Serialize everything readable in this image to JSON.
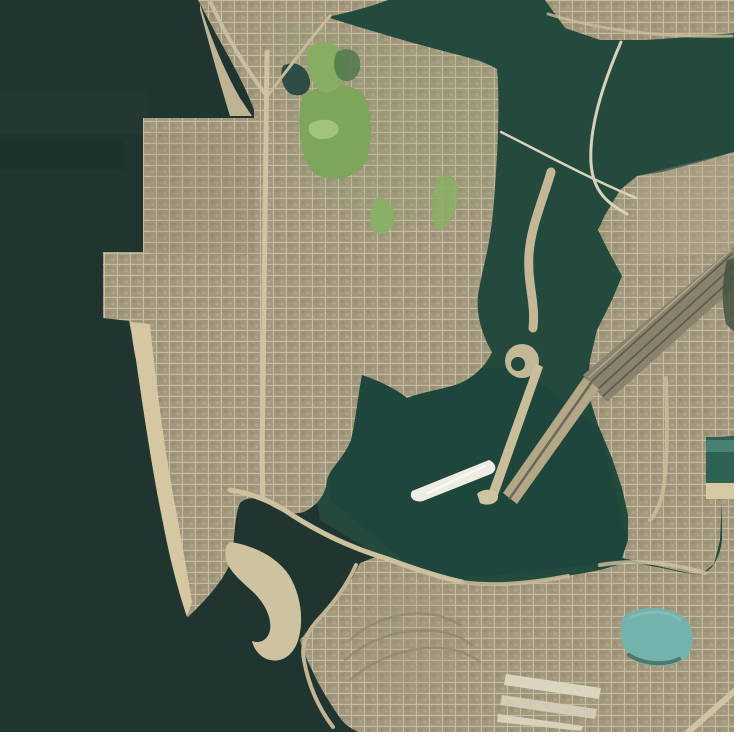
{
  "meta": {
    "kind": "satellite-aerial-photograph",
    "description": "Overhead satellite view of a coastal harbor city: dark sea on the west, a large bay in the northeast, a gridded urban landmass in the center, a green park at top, bridges and causeways over channels, a boat wake in the central basin, a sandy hook spit, a light-teal pond and rail corridor at the lower right. White margins on right and bottom edges.",
    "width": 740,
    "height": 738
  },
  "palette": {
    "ocean": "#213530",
    "bay": "#244a3e",
    "basin": "#1e463c",
    "urban_base": "#a79d84",
    "urban_block": "#a1977d",
    "street": "#c6bb9f",
    "sand": "#d4c7a2",
    "park_green": "#7da55c",
    "pond_teal": "#74b2ac",
    "bridge": "#d9d1b9",
    "wake_white": "#eceee4",
    "rail_dark": "#8a826d",
    "margin_white": "#ffffff"
  },
  "features": [
    "open-sea-west",
    "north-bay",
    "central-basin-with-boat-wake",
    "street-grid-city",
    "hilltop-park",
    "two-bay-bridges",
    "winding-channel-causeway",
    "twin-jetty-causeways",
    "rail-corridor",
    "beach-strip-peninsula",
    "hook-sand-spit",
    "teal-pond",
    "dock-basin-right-edge",
    "industrial-warehouses"
  ],
  "map": {
    "viewbox": "0 0 740 738",
    "layers": [
      {
        "name": "sea-base",
        "shape": "rect",
        "x": 0,
        "y": 0,
        "w": 740,
        "h": 738,
        "fill": "#213530"
      },
      {
        "name": "sea-current-band-1",
        "shape": "rect",
        "x": 0,
        "y": 92,
        "w": 150,
        "h": 42,
        "fill": "#27403a",
        "opacity": 0.35
      },
      {
        "name": "sea-current-band-2",
        "shape": "rect",
        "x": 0,
        "y": 140,
        "w": 125,
        "h": 30,
        "fill": "#1b2d28",
        "opacity": 0.35
      },
      {
        "name": "bay-water",
        "shape": "path",
        "d": "M280,0 L740,0 L740,612 L470,612 L320,520 L280,300 Z",
        "fill": "#244a3e"
      },
      {
        "name": "basin-water",
        "shape": "path",
        "d": "M330,368 L520,368 L600,428 L632,560 L430,582 L330,500 Z",
        "fill": "#1e463c",
        "opacity": 0.9
      },
      {
        "name": "central-landmass",
        "shape": "path",
        "d": "M198,0 L388,0 C370,7 346,13 327,17 C355,26 395,38 432,48 C458,55 482,60 497,69 C500,100 498,150 494,200 C491,245 483,265 478,295 C476,315 482,335 492,352 C486,366 473,378 458,384 C440,390 422,392 407,398 C398,390 380,381 362,375 C358,395 356,418 351,440 C344,458 330,468 327,480 C326,492 320,504 304,512 C292,515 282,513 270,505 C258,497 247,496 240,503 C235,515 234,535 233,556 C226,578 208,598 188,617 C177,575 163,510 152,445 C143,395 135,350 129,321 L103,318 L103,252 L143,252 L143,118 L254,118 L254,110 C247,90 232,62 216,34 Z",
        "fill": "url(#urban)"
      },
      {
        "name": "north-shore-strip",
        "shape": "path",
        "d": "M545,0 L734,0 L734,33 L690,37 L645,40 L600,40 L565,28 Z",
        "fill": "url(#urban)"
      },
      {
        "name": "east-landmass",
        "shape": "path",
        "d": "M734,152 L700,162 L662,172 L637,176 L620,190 L605,215 L598,230 L609,252 L622,276 L612,300 L597,330 L590,360 L587,390 L598,425 L612,458 L622,488 L628,515 L628,540 L622,558 L645,563 L675,570 L700,575 L714,564 L720,540 L722,502 L712,496 L706,484 L706,438 L734,436 Z",
        "fill": "url(#urban)"
      },
      {
        "name": "south-landmass",
        "shape": "path",
        "d": "M300,640 L318,618 L338,598 L352,578 L360,563 L378,556 C390,558 400,562 410,567 C428,574 448,581 468,584 C490,586 515,585 540,580 C560,577 580,574 600,570 L628,562 C645,565 660,567 680,572 L700,575 C707,572 712,568 714,564 C719,556 721,548 722,540 L722,502 L712,496 L706,484 L734,484 L734,732 L358,732 C350,728 344,724 340,718 C330,703 320,688 312,670 C306,658 302,648 300,640 Z",
        "fill": "url(#urban)"
      },
      {
        "name": "park-slope-cast",
        "shape": "path",
        "d": "M280,20 L480,60 L497,69 L494,200 L380,232 L300,180 Z",
        "fill": "#9aa37c",
        "opacity": 0.22
      },
      {
        "name": "downtown-shade",
        "shape": "rect",
        "x": 150,
        "y": 130,
        "w": 105,
        "h": 125,
        "fill": "#8f8267",
        "opacity": 0.18
      },
      {
        "name": "east-city-light",
        "shape": "path",
        "d": "M637,176 L734,152 L734,250 L640,262 Z",
        "fill": "#b6ab8e",
        "opacity": 0.3
      },
      {
        "name": "estate-rings-light",
        "shape": "circle",
        "cx": 408,
        "cy": 640,
        "r": 56,
        "fill": "#a1977c",
        "opacity": 0.25
      },
      {
        "name": "north-sand-strip",
        "shape": "path",
        "d": "M200,4 C210,36 224,70 240,98 L252,116 L230,116 C219,80 208,40 200,10 Z",
        "fill": "#cfc19d",
        "opacity": 0.9
      },
      {
        "name": "west-beach",
        "shape": "path",
        "d": "M131,322 L150,324 C156,384 165,455 177,515 C182,545 188,575 192,602 L187,617 C178,590 170,560 163,523 C152,470 143,408 136,360 C133,345 131,332 131,322 Z",
        "fill": "#d4c7a2"
      },
      {
        "name": "hook-sand-spit",
        "shape": "path",
        "d": "M230,542 C252,545 276,556 289,575 C300,593 304,617 299,637 C295,654 283,663 270,660 C261,658 254,650 252,641 C260,644 268,640 270,630 C272,617 264,602 252,591 C241,581 230,572 226,560 C224,551 226,545 230,542 Z",
        "fill": "#cfc2a0"
      },
      {
        "name": "park-main",
        "shape": "path",
        "d": "M302,98 C315,85 342,80 362,92 C372,105 374,140 366,162 C355,180 328,184 313,172 C300,158 296,120 302,98 Z",
        "fill": "#7da55c"
      },
      {
        "name": "park-upper",
        "shape": "path",
        "d": "M308,48 C322,38 340,42 346,58 C349,74 342,90 327,93 C313,92 303,66 308,48 Z",
        "fill": "#86ad62"
      },
      {
        "name": "park-meadow",
        "shape": "path",
        "d": "M310,124 C318,118 334,118 338,126 C341,134 332,140 320,139 C311,138 306,130 310,124 Z",
        "fill": "#a5c77f",
        "opacity": 0.9
      },
      {
        "name": "green-patch-south",
        "shape": "path",
        "d": "M377,198 C388,196 396,205 394,220 C392,232 382,238 374,232 C368,222 370,205 377,198 Z",
        "fill": "#8ab068"
      },
      {
        "name": "green-patch-east",
        "shape": "path",
        "d": "M440,175 C452,172 460,180 458,196 C456,215 448,232 438,230 C430,226 430,188 440,175 Z",
        "fill": "#8aaf66",
        "opacity": 0.85
      },
      {
        "name": "park-woods",
        "shape": "path",
        "d": "M337,52 C350,45 362,52 360,68 C358,81 345,85 338,77 C333,70 333,60 337,52 Z",
        "fill": "#567a50",
        "opacity": 0.9
      },
      {
        "name": "park-pond",
        "shape": "path",
        "d": "M283,66 C295,59 308,67 310,81 C311,93 301,98 291,94 C282,89 279,74 283,66 Z",
        "fill": "#2e4d44"
      },
      {
        "name": "road-top-west",
        "shape": "path",
        "d": "M211,3 C226,36 247,70 266,95",
        "stroke": "#cbbe9c",
        "width": 4
      },
      {
        "name": "road-top-east",
        "shape": "path",
        "d": "M268,95 C295,60 315,33 330,16",
        "stroke": "#c7ba96",
        "width": 3
      },
      {
        "name": "road-main-vertical",
        "shape": "path",
        "d": "M267,52 C266,150 264,280 263,400 C262,440 262,470 263,495",
        "stroke": "#d0c3a1",
        "width": 5
      },
      {
        "name": "road-shore",
        "shape": "path",
        "d": "M230,490 C255,494 275,503 292,515 C320,533 352,548 385,558 C412,568 438,577 462,582",
        "stroke": "#cdc19f",
        "width": 5
      },
      {
        "name": "road-shore-east",
        "shape": "path",
        "d": "M462,582 C495,587 532,583 568,576",
        "stroke": "#c6ba98",
        "width": 4,
        "opacity": 0.9
      },
      {
        "name": "road-inlet",
        "shape": "path",
        "d": "M356,565 C346,588 330,607 316,622 C306,634 301,647 304,660 C309,688 320,710 333,727",
        "stroke": "#c2b593",
        "width": 4
      },
      {
        "name": "road-east-vertical",
        "shape": "path",
        "d": "M666,378 C667,420 668,450 664,485 C662,500 657,512 650,520",
        "stroke": "#c8bb99",
        "width": 4,
        "opacity": 0.9
      },
      {
        "name": "road-north-shore",
        "shape": "path",
        "d": "M548,14 C600,30 660,38 732,36",
        "stroke": "#c9bd9b",
        "width": 3,
        "opacity": 0.8
      },
      {
        "name": "rail-corridor",
        "shape": "path",
        "d": "M734,246 L734,288 L607,402 L583,375 Z",
        "fill": "#8a826d"
      },
      {
        "name": "rail-tracks",
        "shape": "path",
        "d": "M732,254 L592,381 M733,266 L598,389 M733,278 L603,396",
        "stroke": "#605d4d",
        "width": 1.8
      },
      {
        "name": "rail-highlight",
        "shape": "path",
        "d": "M731,250 L589,377",
        "stroke": "#b0a88c",
        "width": 1.5
      },
      {
        "name": "channel-causeway",
        "shape": "path",
        "d": "M551,172 C543,200 531,226 529,254 C527,284 536,303 533,328",
        "stroke": "#c3b795",
        "width": 9
      },
      {
        "name": "causeway-bulb",
        "shape": "circle",
        "cx": 522,
        "cy": 361,
        "r": 17,
        "fill": "#c3b795"
      },
      {
        "name": "causeway-bulb-lagoon",
        "shape": "circle",
        "cx": 518,
        "cy": 364,
        "r": 7,
        "fill": "#234a3e"
      },
      {
        "name": "jetty-thin",
        "shape": "path",
        "d": "M535,363 L543,367 L497,498 L488,494 Z",
        "fill": "#cabd99"
      },
      {
        "name": "jetty-wide",
        "shape": "path",
        "d": "M584,377 L599,389 L517,504 L503,493 Z",
        "fill": "#b3a786"
      },
      {
        "name": "jetty-wide-streak",
        "shape": "path",
        "d": "M591,383 L510,498",
        "stroke": "#6d685a",
        "width": 2.5
      },
      {
        "name": "jetty-tip-sand",
        "shape": "path",
        "d": "M477,494 C482,488 496,488 498,496 C499,503 488,507 480,503 Z",
        "fill": "#d0c39f"
      },
      {
        "name": "bay-bridge-curved",
        "shape": "path",
        "d": "M621,42 C601,88 589,130 591,163 C593,193 609,204 627,214",
        "stroke": "#d9d1b9",
        "width": 3
      },
      {
        "name": "bay-bridge-straight",
        "shape": "path",
        "d": "M501,132 C541,152 584,176 636,198",
        "stroke": "#d9d1b9",
        "width": 2.5
      },
      {
        "name": "boat-wake",
        "shape": "path",
        "d": "M489,460 C496,463 498,470 491,474 L423,501 C415,503 408,498 412,491 Z",
        "fill": "#eceee4"
      },
      {
        "name": "boat-wake-core",
        "shape": "path",
        "d": "M485,466 L428,493",
        "stroke": "#fbfcf8",
        "width": 2
      },
      {
        "name": "lagoon-south-sand",
        "shape": "path",
        "d": "M600,565 C640,558 680,565 705,573",
        "stroke": "#d0c3a0",
        "width": 4,
        "opacity": 0.8
      },
      {
        "name": "teal-pond",
        "shape": "path",
        "d": "M624,616 C639,605 669,605 685,618 C696,629 695,649 685,659 C670,669 643,669 631,658 C621,648 617,628 624,616 Z",
        "fill": "#74b2ac"
      },
      {
        "name": "teal-pond-rim",
        "shape": "path",
        "d": "M629,655 C643,664 664,666 679,659",
        "stroke": "#40604f",
        "width": 4,
        "opacity": 0.7
      },
      {
        "name": "teal-pond-highlight",
        "shape": "path",
        "d": "M630,618 C645,610 668,610 680,620",
        "stroke": "#8ec4bd",
        "width": 3,
        "opacity": 0.6
      },
      {
        "name": "dock-basin",
        "shape": "rect",
        "x": 706,
        "y": 437,
        "w": 28,
        "h": 46,
        "fill": "#2e6154"
      },
      {
        "name": "dock-basin-sheen",
        "shape": "rect",
        "x": 706,
        "y": 440,
        "w": 28,
        "h": 12,
        "fill": "#4c8a7c",
        "opacity": 0.8
      },
      {
        "name": "dock-sand",
        "shape": "rect",
        "x": 706,
        "y": 483,
        "w": 28,
        "h": 16,
        "fill": "#d6c8a2"
      },
      {
        "name": "warehouse-1",
        "shape": "path",
        "d": "M506,674 L601,688 L599,699 L504,685 Z",
        "fill": "#dbd4be"
      },
      {
        "name": "warehouse-2",
        "shape": "path",
        "d": "M502,695 L597,709 L595,719 L500,705 Z",
        "fill": "#d3cbb3"
      },
      {
        "name": "warehouse-3",
        "shape": "path",
        "d": "M498,714 L583,726 L581,731 L497,722 Z",
        "fill": "#d9d1bb"
      },
      {
        "name": "estate-curved-streets",
        "shape": "path",
        "d": "M350,640 C380,612 430,605 460,625 M345,660 C380,628 440,620 472,645 M350,680 C390,645 450,638 480,662",
        "stroke": "#8d846c",
        "width": 2.5,
        "opacity": 0.7
      },
      {
        "name": "edge-vegetation",
        "shape": "path",
        "d": "M727,260 L734,258 L734,332 L726,324 C721,302 722,280 727,260 Z",
        "fill": "#44543f",
        "opacity": 0.85
      },
      {
        "name": "road-corner-diagonal",
        "shape": "path",
        "d": "M737,689 L684,736",
        "stroke": "#cfc4a4",
        "width": 6
      },
      {
        "name": "margin-right",
        "shape": "rect",
        "x": 734,
        "y": 0,
        "w": 6,
        "h": 738,
        "fill": "#ffffff"
      },
      {
        "name": "margin-bottom",
        "shape": "rect",
        "x": 0,
        "y": 732,
        "w": 740,
        "h": 6,
        "fill": "#ffffff"
      }
    ]
  }
}
